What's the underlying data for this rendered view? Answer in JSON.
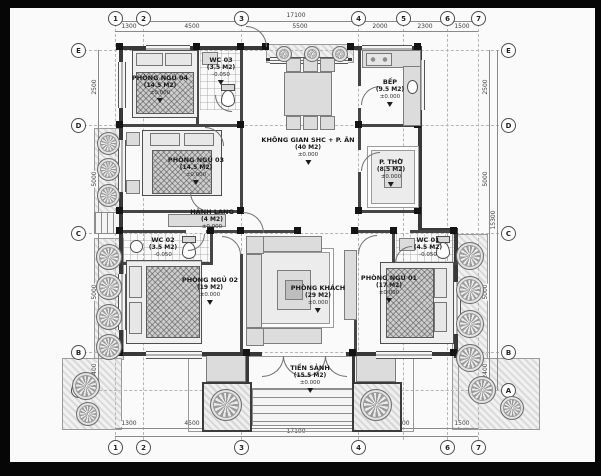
{
  "rooms": {
    "bedroom4": {
      "name": "PHÒNG NGỦ 04",
      "area": "(14.5 M2)",
      "level": "±0.000"
    },
    "wc3": {
      "name": "WC 03",
      "area": "(3.5 M2)",
      "level": "-0.050"
    },
    "kitchen": {
      "name": "BẾP",
      "area": "(9.5 M2)",
      "level": "±0.000"
    },
    "common": {
      "name": "KHÔNG GIAN SHC + P. ĂN",
      "area": "(40 M2)",
      "level": "±0.000"
    },
    "worship": {
      "name": "P. THỜ",
      "area": "(8.5 M2)",
      "level": "±0.000"
    },
    "bedroom3": {
      "name": "PHÒNG NGỦ 03",
      "area": "(14.5 M2)",
      "level": "±0.000"
    },
    "hall": {
      "name": "HÀNH LANG",
      "area": "(4 M2)",
      "level": "±0.000"
    },
    "wc2": {
      "name": "WC 02",
      "area": "(3.5 M2)",
      "level": "-0.050"
    },
    "bedroom2": {
      "name": "PHÒNG NGỦ 02",
      "area": "(19 M2)",
      "level": "±0.000"
    },
    "living": {
      "name": "PHÒNG KHÁCH",
      "area": "(29 M2)",
      "level": "±0.000"
    },
    "bedroom1": {
      "name": "PHÒNG NGỦ 01",
      "area": "(17 M2)",
      "level": "±0.000"
    },
    "wc1": {
      "name": "WC 01",
      "area": "(4.5 M2)",
      "level": "-0.050"
    },
    "porch": {
      "name": "TIỀN SẢNH",
      "area": "(15.5 M2)",
      "level": "±0.000"
    }
  },
  "axes": {
    "top": [
      "1",
      "2",
      "3",
      "4",
      "5",
      "6",
      "7"
    ],
    "bottom": [
      "1",
      "2",
      "3",
      "4",
      "6",
      "7"
    ],
    "left": [
      "E",
      "D",
      "C",
      "B",
      "A"
    ],
    "right": [
      "E",
      "D",
      "C",
      "B",
      "A"
    ]
  },
  "dimensions": {
    "top_overall": "17100",
    "top_segments": [
      "1300",
      "4500",
      "5500",
      "2000",
      "2300",
      "1500"
    ],
    "bottom_overall": "17100",
    "bottom_segments": [
      "1300",
      "4500",
      "3500",
      "4000",
      "1500"
    ],
    "left_segments": [
      "2500",
      "5000",
      "5000",
      "2400"
    ],
    "right_segments": [
      "2500",
      "5000",
      "5000",
      "2400"
    ],
    "right_overall": "15300"
  }
}
